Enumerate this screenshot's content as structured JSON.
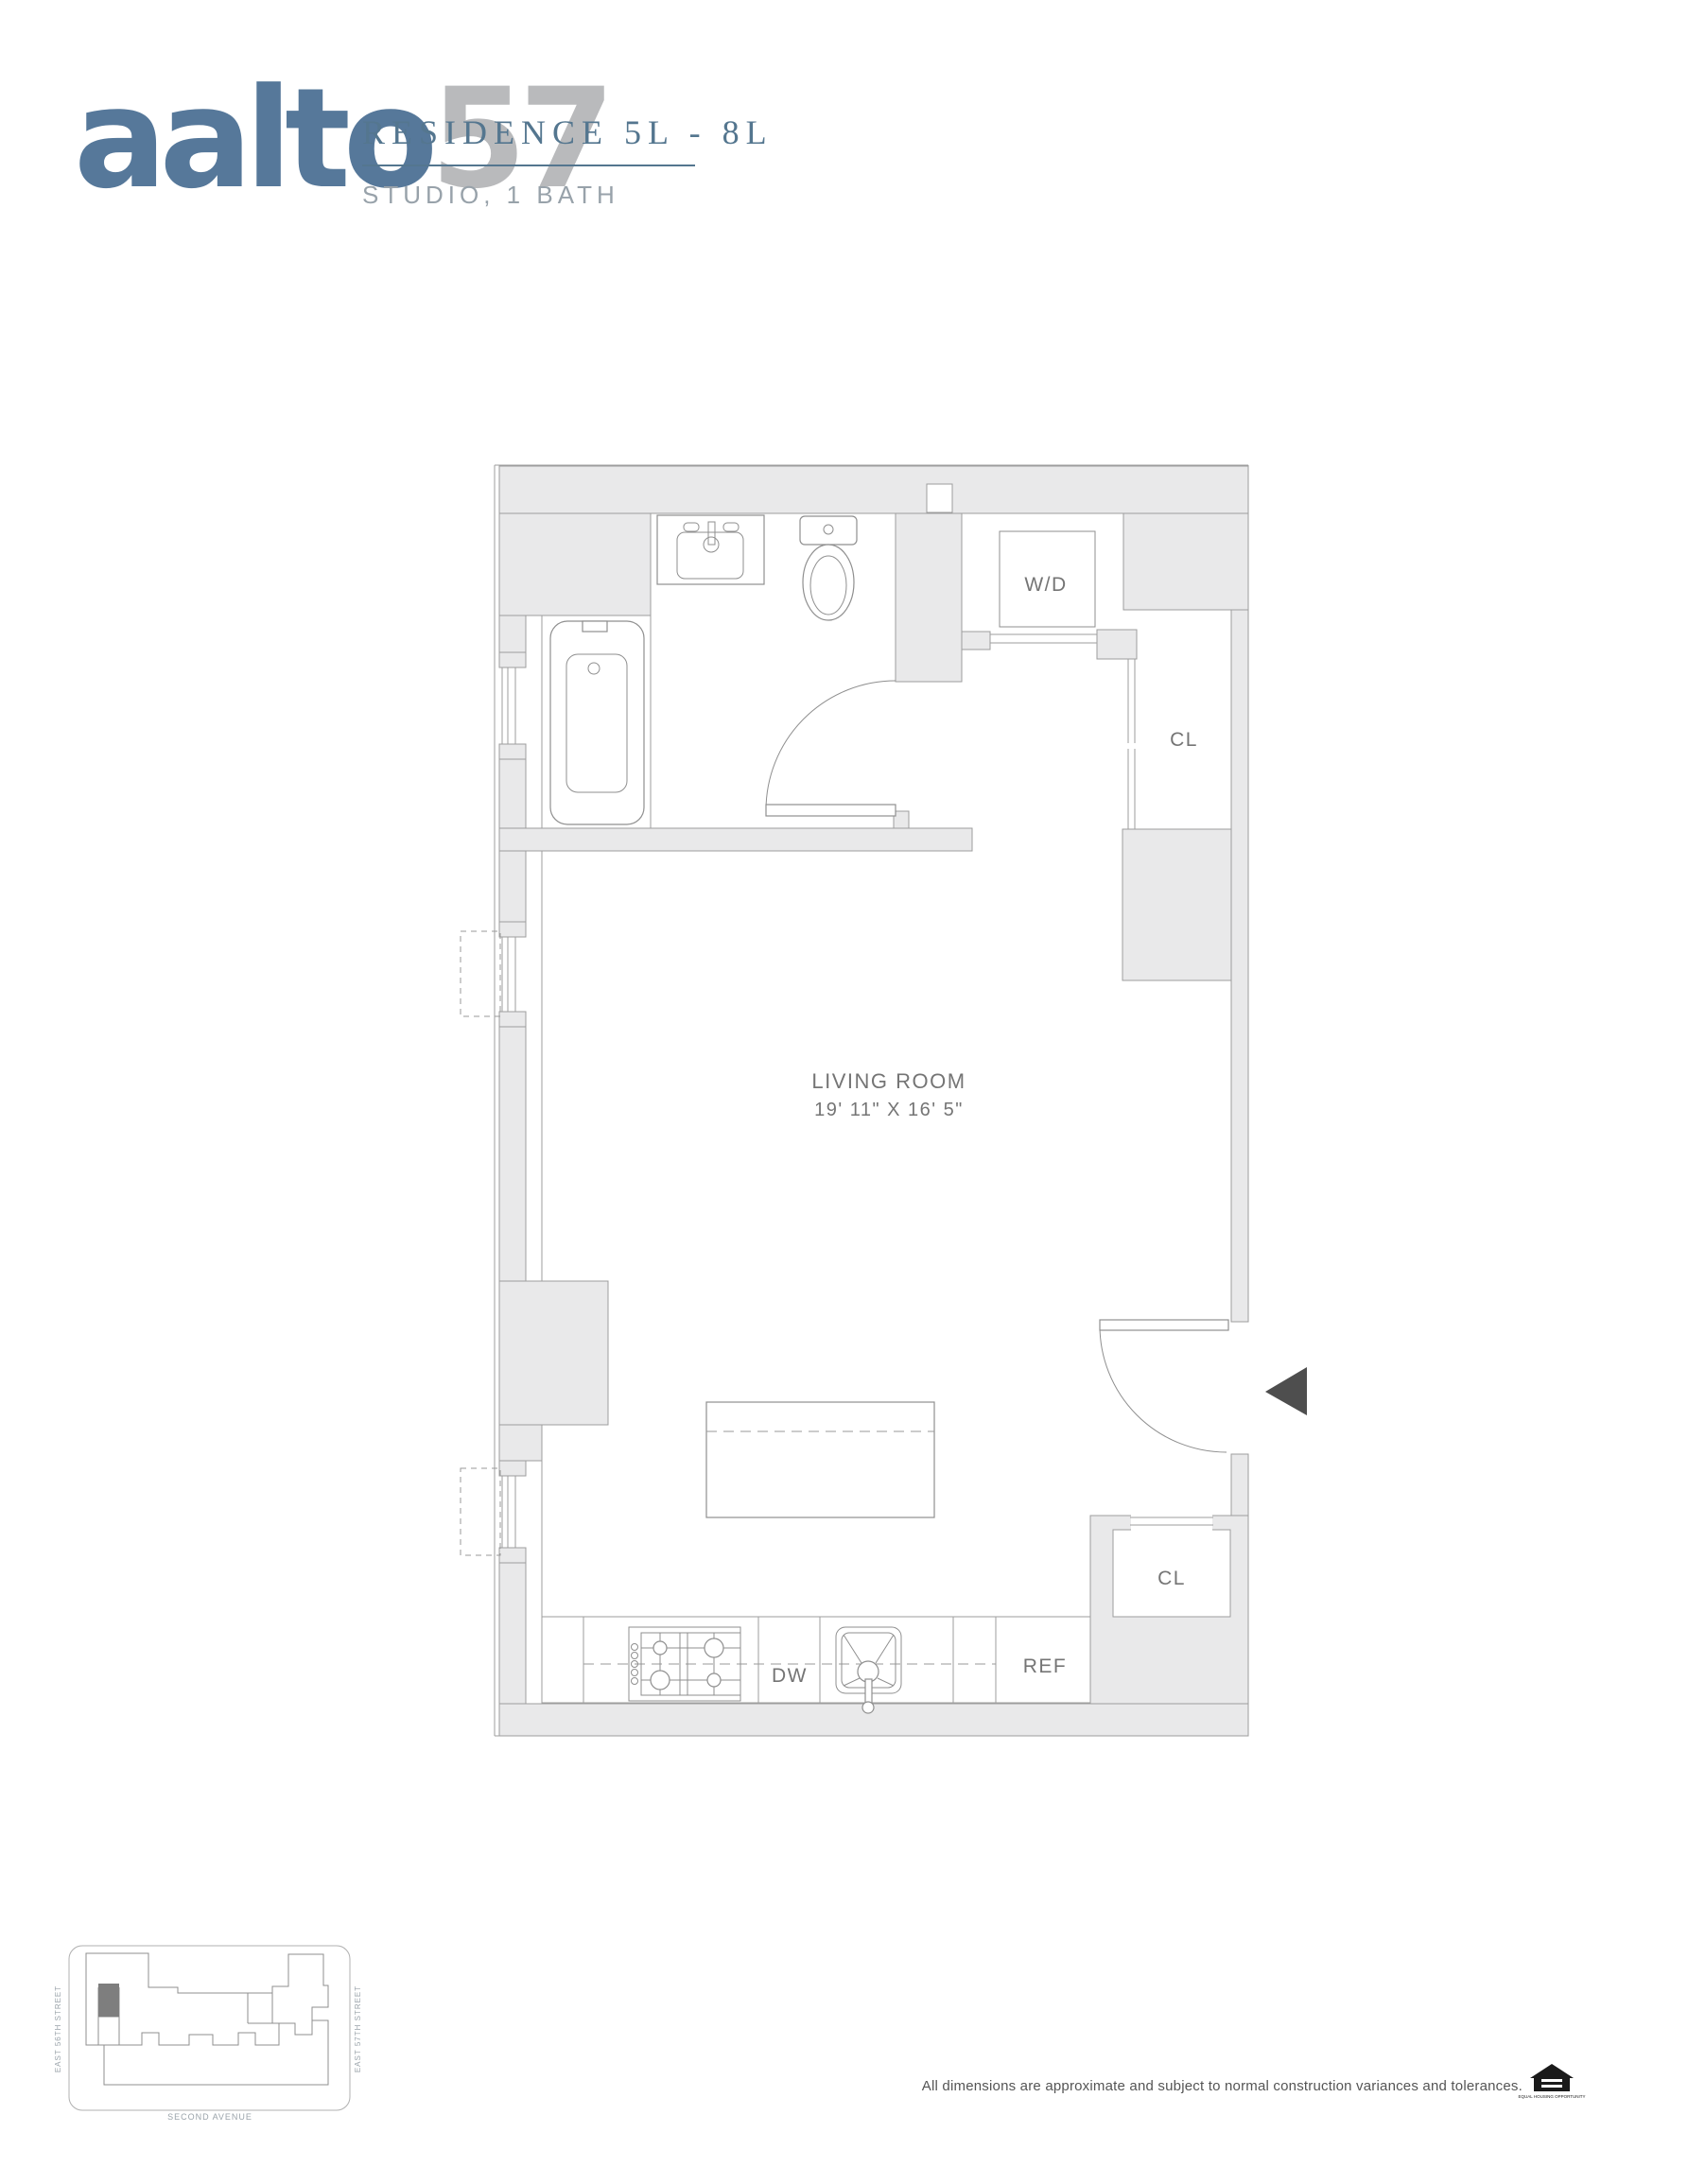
{
  "header": {
    "logo_part1": "aalto",
    "logo_part2": "57",
    "title": "RESIDENCE 5L - 8L",
    "subtitle": "STUDIO, 1 BATH",
    "accent_color": "#54768f",
    "logo_primary_color": "#56789a",
    "logo_secondary_color": "#b9babc"
  },
  "floorplan": {
    "wall_fill_color": "#e9e9ea",
    "line_color": "#9d9d9d",
    "labels": {
      "living_room": "LIVING ROOM",
      "living_room_dims": "19' 11\" X 16' 5\"",
      "washer_dryer": "W/D",
      "closet_top": "CL",
      "closet_bottom": "CL",
      "dishwasher": "DW",
      "refrigerator": "REF"
    }
  },
  "keyplan": {
    "street_left": "EAST 56TH STREET",
    "street_right": "EAST 57TH STREET",
    "street_bottom": "SECOND AVENUE"
  },
  "footer": {
    "disclaimer": "All dimensions are approximate and subject to normal construction variances and tolerances.",
    "eho": "EQUAL HOUSING OPPORTUNITY"
  }
}
